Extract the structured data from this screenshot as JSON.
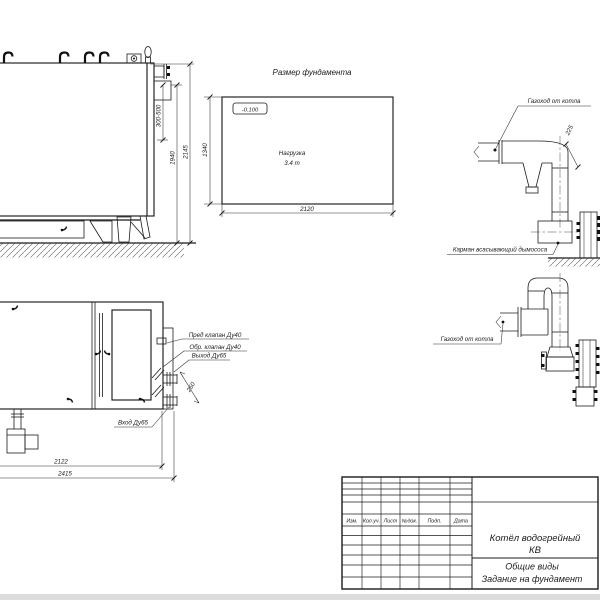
{
  "side_view": {
    "dim_flue_range": "300-500",
    "dim_body_height": "1940",
    "dim_total_height": "2145"
  },
  "foundation_plan": {
    "title": "Размер фундамента",
    "level_mark": "-0.100",
    "load_line1": "Нагрузка",
    "load_line2": "3.4 т",
    "dim_height": "1340",
    "dim_width": "2120"
  },
  "flue_upper": {
    "label_duct": "Газоход от котла",
    "dim_offset": "225",
    "label_pocket": "Карман всасывающий дымососа"
  },
  "flue_lower": {
    "label_duct": "Газоход от котла"
  },
  "top_view": {
    "label_safety_valve": "Пред клапан Ду40",
    "label_check_valve": "Обр. клапан Ду40",
    "label_outlet": "Выход Ду65",
    "label_inlet": "Вход Ду65",
    "dim_ports": "250",
    "dim_length_inner": "2122",
    "dim_length_outer": "2415"
  },
  "title_block": {
    "columns": [
      "Изм.",
      "Кол.уч.",
      "Лист",
      "№док.",
      "Подп.",
      "Дата"
    ],
    "product_line1": "Котёл водогрейный",
    "product_line2": "КВ",
    "doc_line1": "Общие виды",
    "doc_line2": "Задание на фундамент"
  },
  "colors": {
    "line": "#1b1b1b",
    "background": "#ffffff",
    "sheet_edge": "#dcdcdc"
  }
}
